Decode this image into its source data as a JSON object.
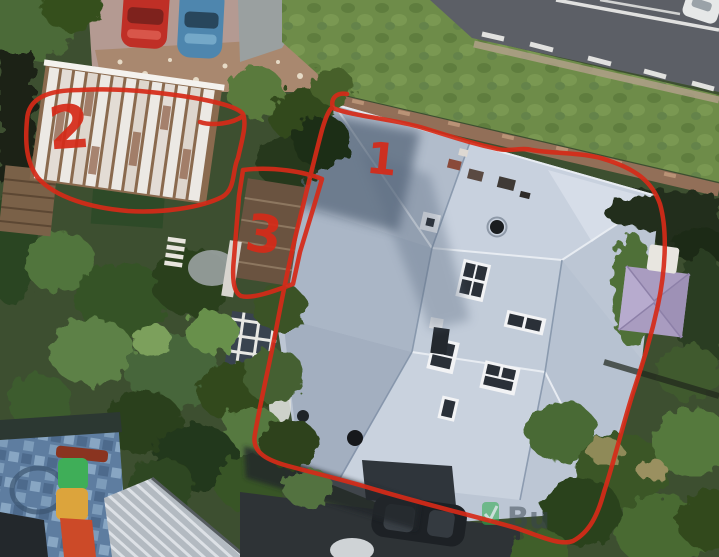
{
  "scene": {
    "type": "aerial-satellite-photo",
    "description": "Aerial satellite view of a residential property with hand-drawn red markup outlining three structures"
  },
  "annotations": {
    "stroke_color": "#d62a18",
    "items": [
      {
        "label": "1",
        "target": "main-house-roof"
      },
      {
        "label": "2",
        "target": "white-slat-pergola"
      },
      {
        "label": "3",
        "target": "side-deck-structure"
      }
    ]
  },
  "watermark": {
    "text": "Bu",
    "icon": "green-check-leaf-icon",
    "icon_color": "#2fae4f",
    "text_color": "#39444e"
  },
  "palette": {
    "roof_gray_blue": "#bcc6d4",
    "lawn_green": "#6e8c49",
    "road_gray": "#5c5f66",
    "pavement_pink": "#b49a92",
    "brick_wall": "#926f58",
    "play_mat_blue": "#5e7da0",
    "gazebo_purple": "#a99cc0",
    "annotation_red": "#d62a18"
  },
  "objects": {
    "vehicles": [
      "red-car",
      "blue-car",
      "white-car",
      "black-car"
    ],
    "structures": [
      "main-house-roof",
      "white-slat-pergola",
      "side-deck-structure",
      "corrugated-shed-roof",
      "purple-gazebo",
      "playground-slide",
      "play-mat"
    ]
  }
}
